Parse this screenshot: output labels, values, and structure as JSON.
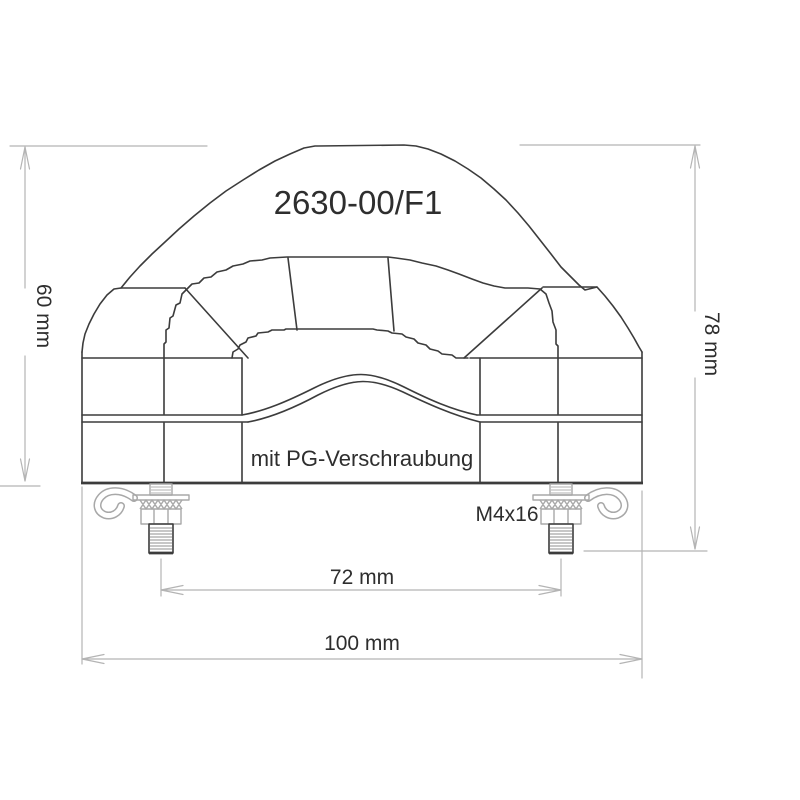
{
  "drawing": {
    "kind": "technical-drawing-cable-clamp",
    "part_number": "2630-00/F1",
    "note": "mit PG-Verschraubung",
    "screw_label": "M4x16",
    "dimensions": {
      "body_height": "60 mm",
      "total_height": "78 mm",
      "bolt_spacing": "72 mm",
      "total_width": "100 mm"
    },
    "colors": {
      "background": "#ffffff",
      "outline": "#3c3c3c",
      "dimension_lines": "#b4b4b4",
      "hardware_lines": "#a8a8a8",
      "text": "#2e2e2e"
    }
  }
}
